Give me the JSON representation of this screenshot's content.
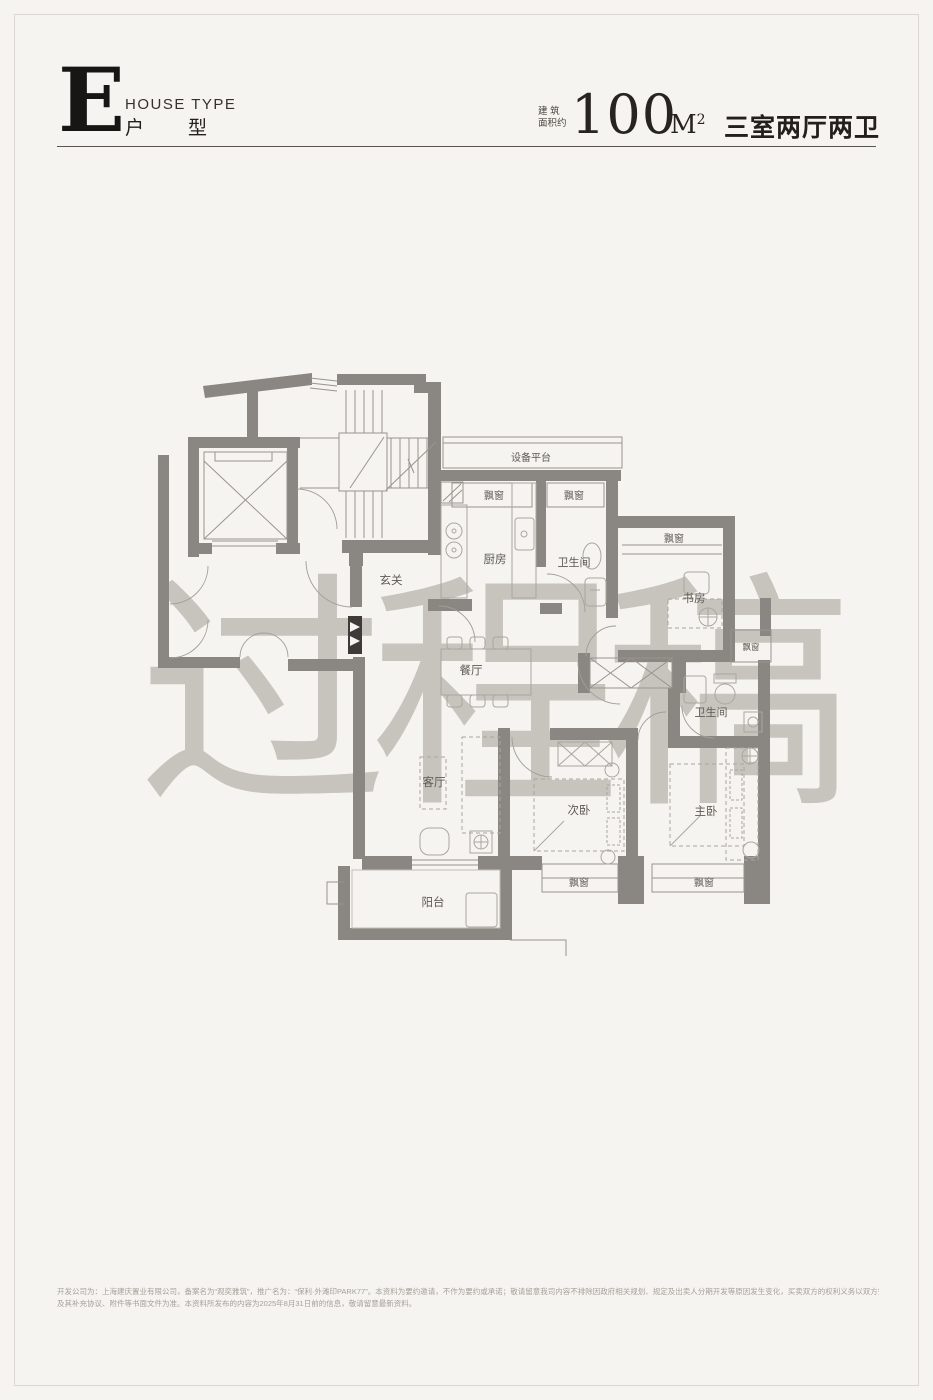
{
  "header": {
    "type_letter": "E",
    "house_type_en": "HOUSE TYPE",
    "house_type_cn_1": "户",
    "house_type_cn_2": "型",
    "area_label_line1": "建 筑",
    "area_label_line2": "面积约",
    "area_value": "100",
    "area_unit_base": "M",
    "area_unit_sup": "2",
    "rooms_summary": "三室两厅两卫"
  },
  "watermark": {
    "text": "过程稿"
  },
  "floorplan": {
    "labels": [
      "设备平台",
      "飘窗",
      "飘窗",
      "厨房",
      "卫生间",
      "飘窗",
      "书房",
      "玄关",
      "飘窗",
      "餐厅",
      "卫生间",
      "客厅",
      "次卧",
      "主卧",
      "阳台",
      "飘窗",
      "飘窗"
    ]
  },
  "footer": {
    "line1": "开发公司为：上海建庆置业有限公司，备案名为“观奕雅筑”，推广名为：“保利·外滩印PARK77”。本资料为要约邀请，不作为要约或承诺；敬请留意我司内容不排除因政府相关规划、规定及出卖人分期开发等原因发生变化，买卖双方的权利义务以双方签订的《商品房买卖合同》",
    "line2": "及其补充协议、附件等书面文件为准。本资料所发布的内容为2025年8月31日前的信息，敬请留意最新资料。"
  },
  "colors": {
    "background": "#f6f4f0",
    "wall": "#8a8681",
    "watermark": "#c7c4be",
    "title": "#181614"
  }
}
